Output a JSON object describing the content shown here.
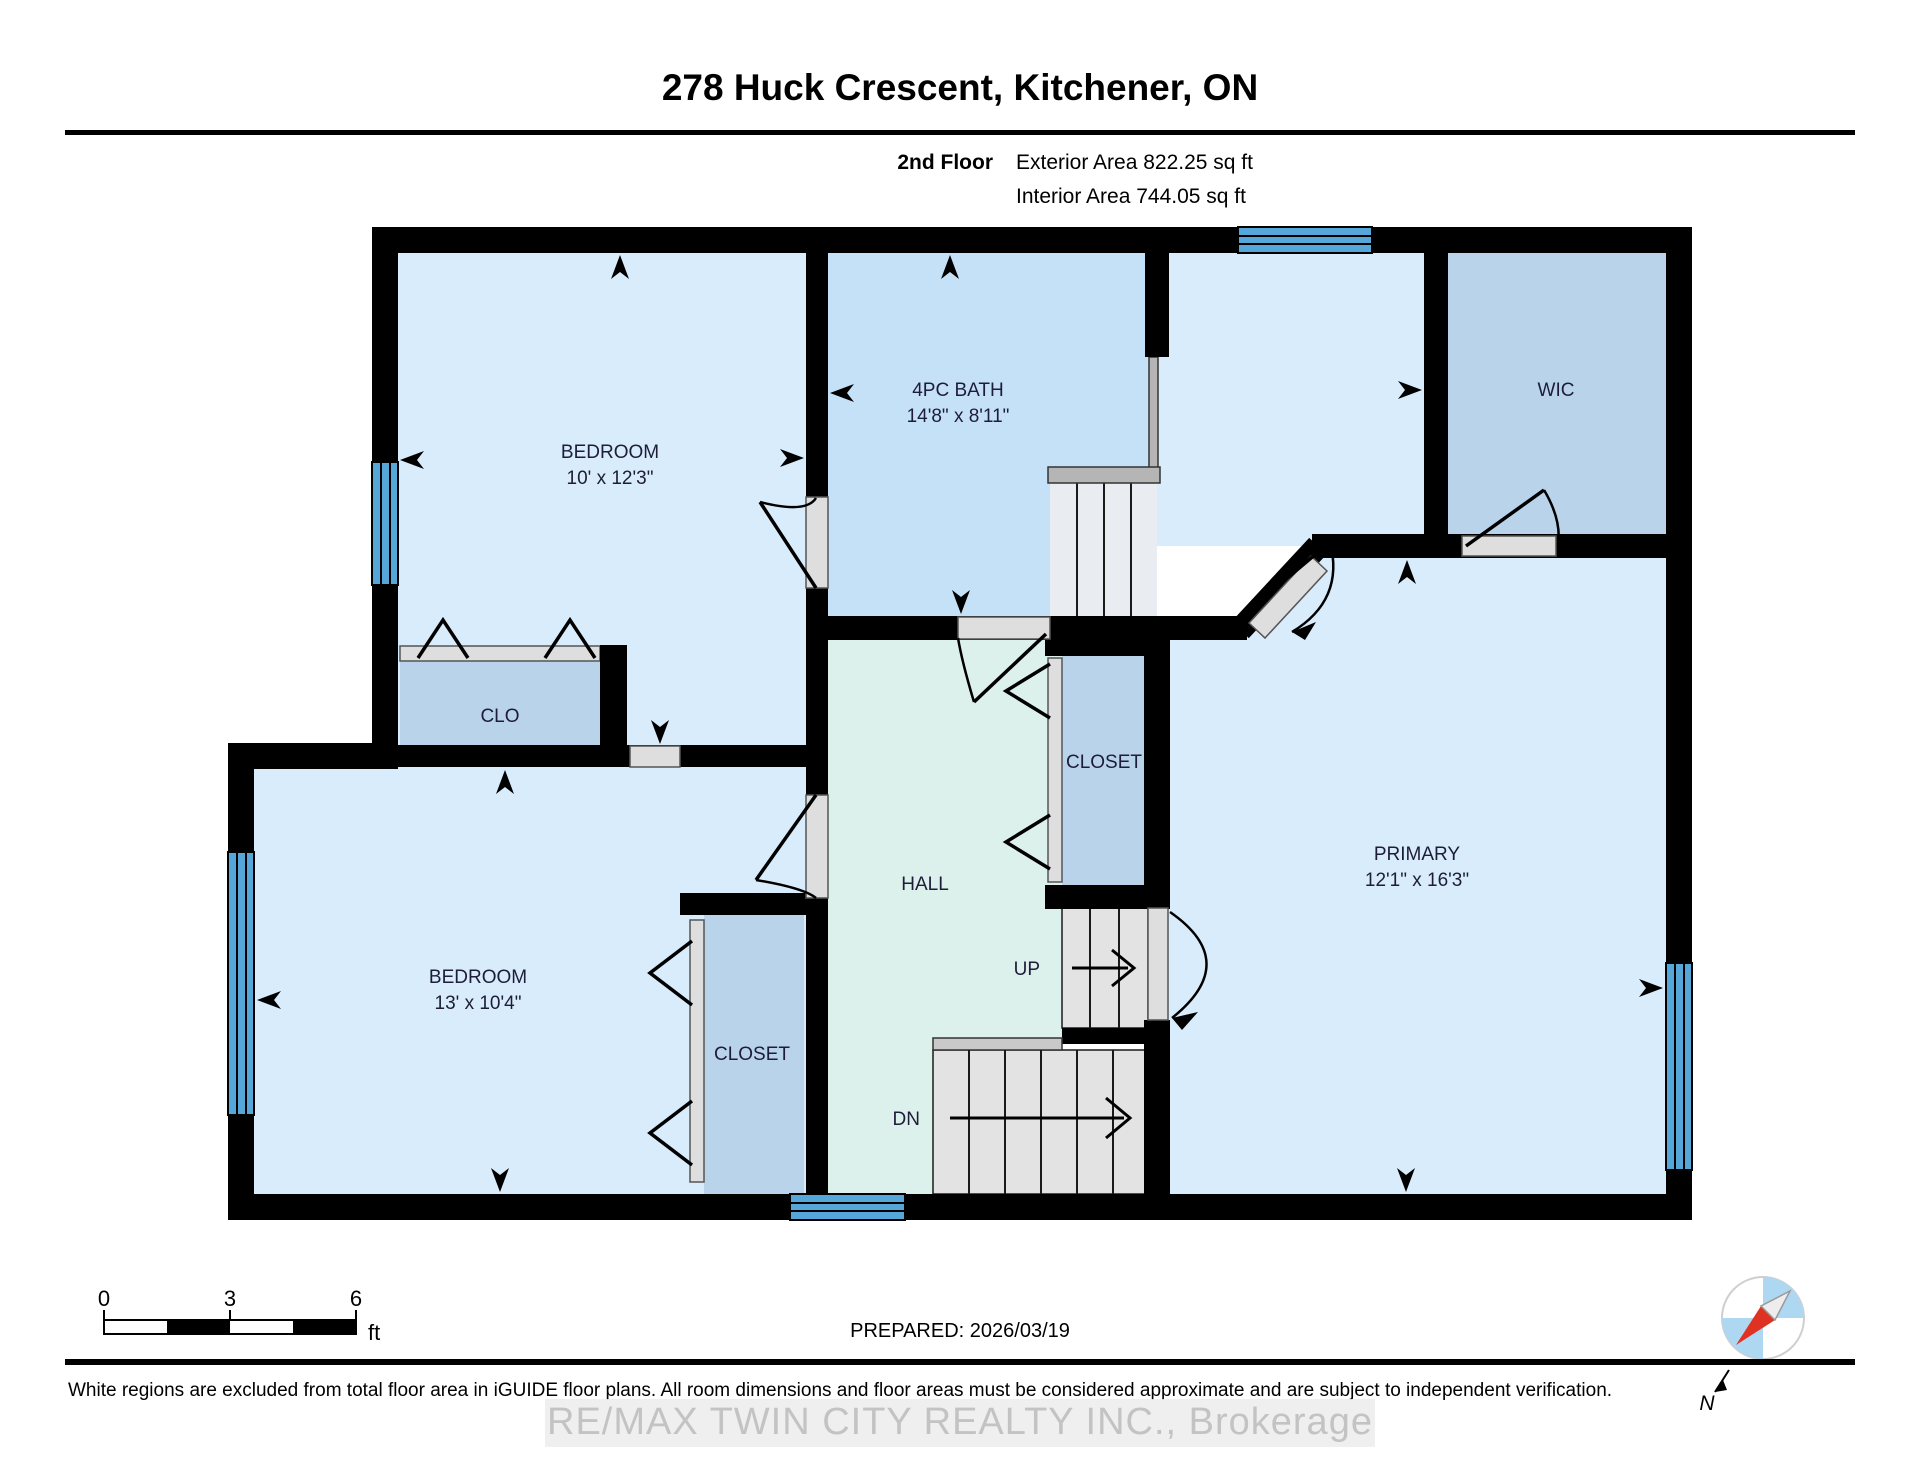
{
  "header": {
    "title": "278 Huck Crescent, Kitchener, ON",
    "floor_label": "2nd Floor",
    "exterior_area": "Exterior Area 822.25 sq ft",
    "interior_area": "Interior Area 744.05 sq ft"
  },
  "rooms": {
    "bedroom1": {
      "name": "BEDROOM",
      "dims": "10' x 12'3\""
    },
    "bath": {
      "name": "4PC BATH",
      "dims": "14'8\" x 8'11\""
    },
    "wic": {
      "name": "WIC"
    },
    "clo": {
      "name": "CLO"
    },
    "bedroom2": {
      "name": "BEDROOM",
      "dims": "13' x 10'4\""
    },
    "closet_upper": {
      "name": "CLOSET"
    },
    "closet_lower": {
      "name": "CLOSET"
    },
    "hall": {
      "name": "HALL"
    },
    "primary": {
      "name": "PRIMARY",
      "dims": "12'1\" x 16'3\""
    },
    "stairs_up": {
      "label": "UP"
    },
    "stairs_down": {
      "label": "DN"
    }
  },
  "scale_bar": {
    "tick_0": "0",
    "tick_3": "3",
    "tick_6": "6",
    "unit": "ft"
  },
  "prepared_label": "PREPARED: 2026/03/19",
  "compass": {
    "north_label": "N"
  },
  "footer": {
    "disclaimer": "White regions are excluded from total floor area in iGUIDE floor plans. All room dimensions and floor areas must be considered approximate and are subject to independent verification.",
    "watermark": "RE/MAX TWIN CITY REALTY INC., Brokerage"
  },
  "colors": {
    "wall": "#000000",
    "room_light": "#d9ecfb",
    "room_medium": "#c5e1f7",
    "room_closet": "#b9d3ea",
    "hall": "#ddf1ec",
    "window": "#55a7da",
    "door_opening": "#dedede",
    "stairs": "#e3e3e3",
    "railing": "#b5b5b5",
    "compass_needle": "#e03222",
    "compass_quadrant": "#aed7f2",
    "watermark_text": "#c3c3c3"
  }
}
